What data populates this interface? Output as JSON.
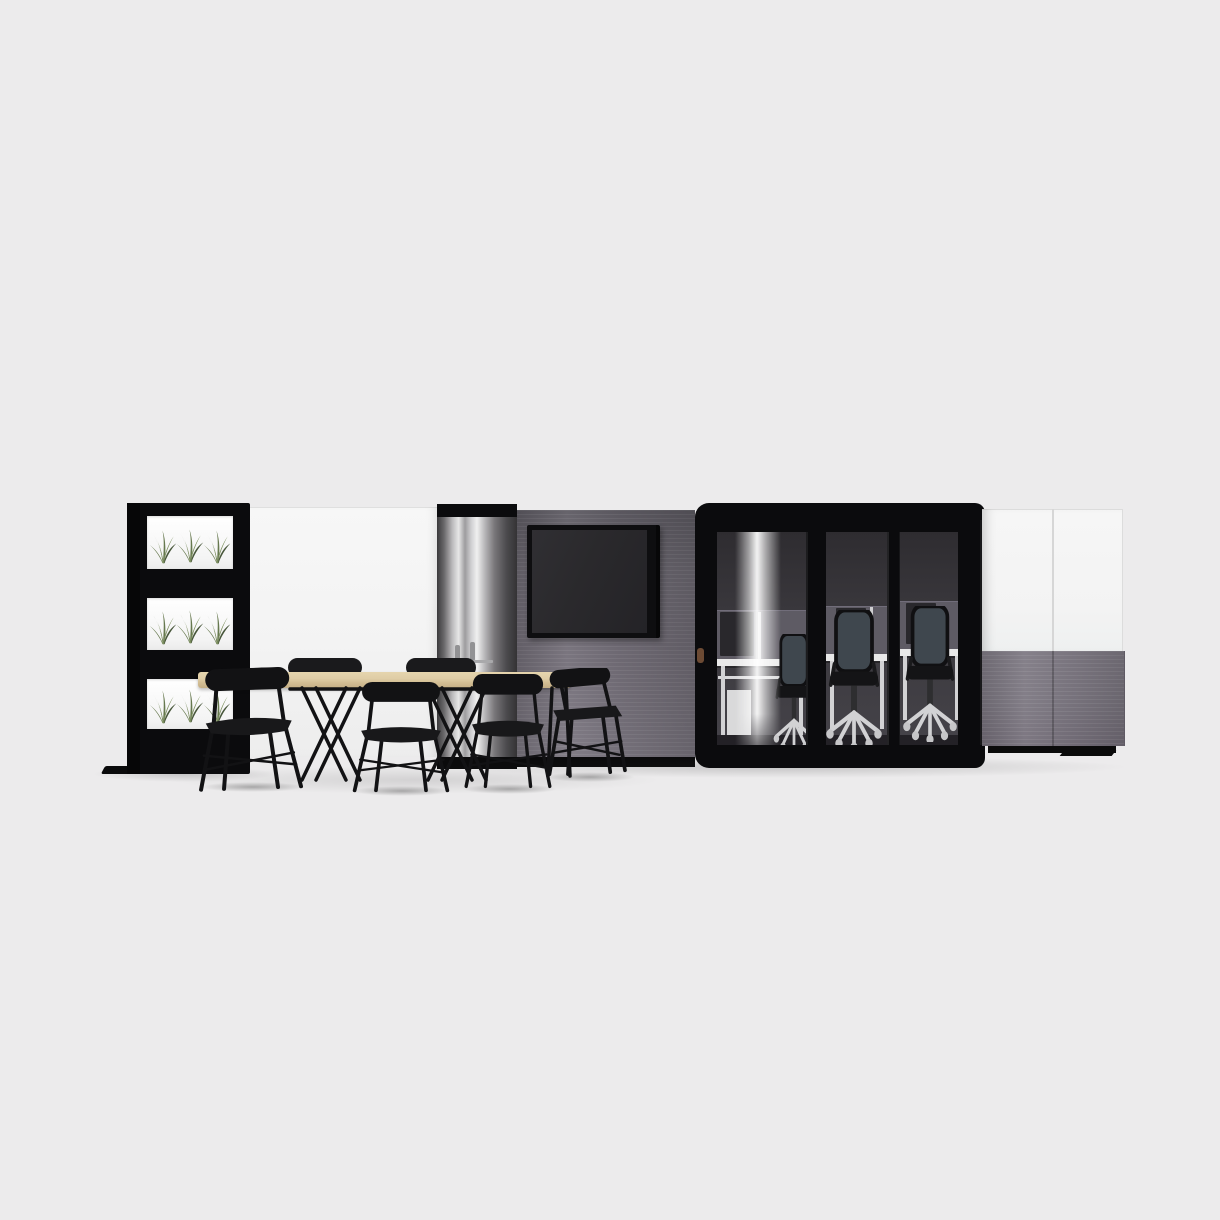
{
  "scene": {
    "type": "3d-product-render",
    "title": "Modular office meeting pod with workstations, media wall, standing-height table and plant partition",
    "background": "#ecebec",
    "objects": [
      "plant-partition-tower",
      "white-wall-panel",
      "chrome-glass-end-panel",
      "coat-hooks",
      "acoustic-ribbed-wall",
      "wall-mounted-tv",
      "glass-meeting-pod",
      "pod-glass-door",
      "door-handle",
      "interior-desk-workstations",
      "desk-divider-screens",
      "office-task-chairs",
      "storage-cabinet-wall",
      "standing-height-table",
      "bar-stool-chairs",
      "floor-shadows"
    ],
    "counts": {
      "plant_boxes": 3,
      "plants_per_box": 3,
      "glass_panels": 3,
      "bar_stools": 6,
      "office_chairs": 3,
      "cabinet_doors": 2
    }
  },
  "palette": {
    "bg": "#ecebec",
    "wall_white": "#f3f3f3",
    "frame_black": "#0b0b0d",
    "fabric_gray": "#6e6a73",
    "fabric_gray_light": "#7b7680",
    "tv_frame": "#0e0e10",
    "tv_screen": "#2a292c",
    "glass_interior": "#3a383d",
    "divider_gray": "#5e5b64",
    "desk_white": "#e9e9e9",
    "wood_light": "#dfcda6",
    "wood_edge": "#c4ae85",
    "chair_black": "#121214",
    "plant_green": "#66784e",
    "plant_green_dark": "#47563a",
    "plant_green_light": "#7e9160",
    "chrome_highlight": "#f0f0f0",
    "office_chair_mesh": "#3f474e",
    "office_chair_base": "#d2d2d4",
    "shadow": "#d7d7d7"
  }
}
